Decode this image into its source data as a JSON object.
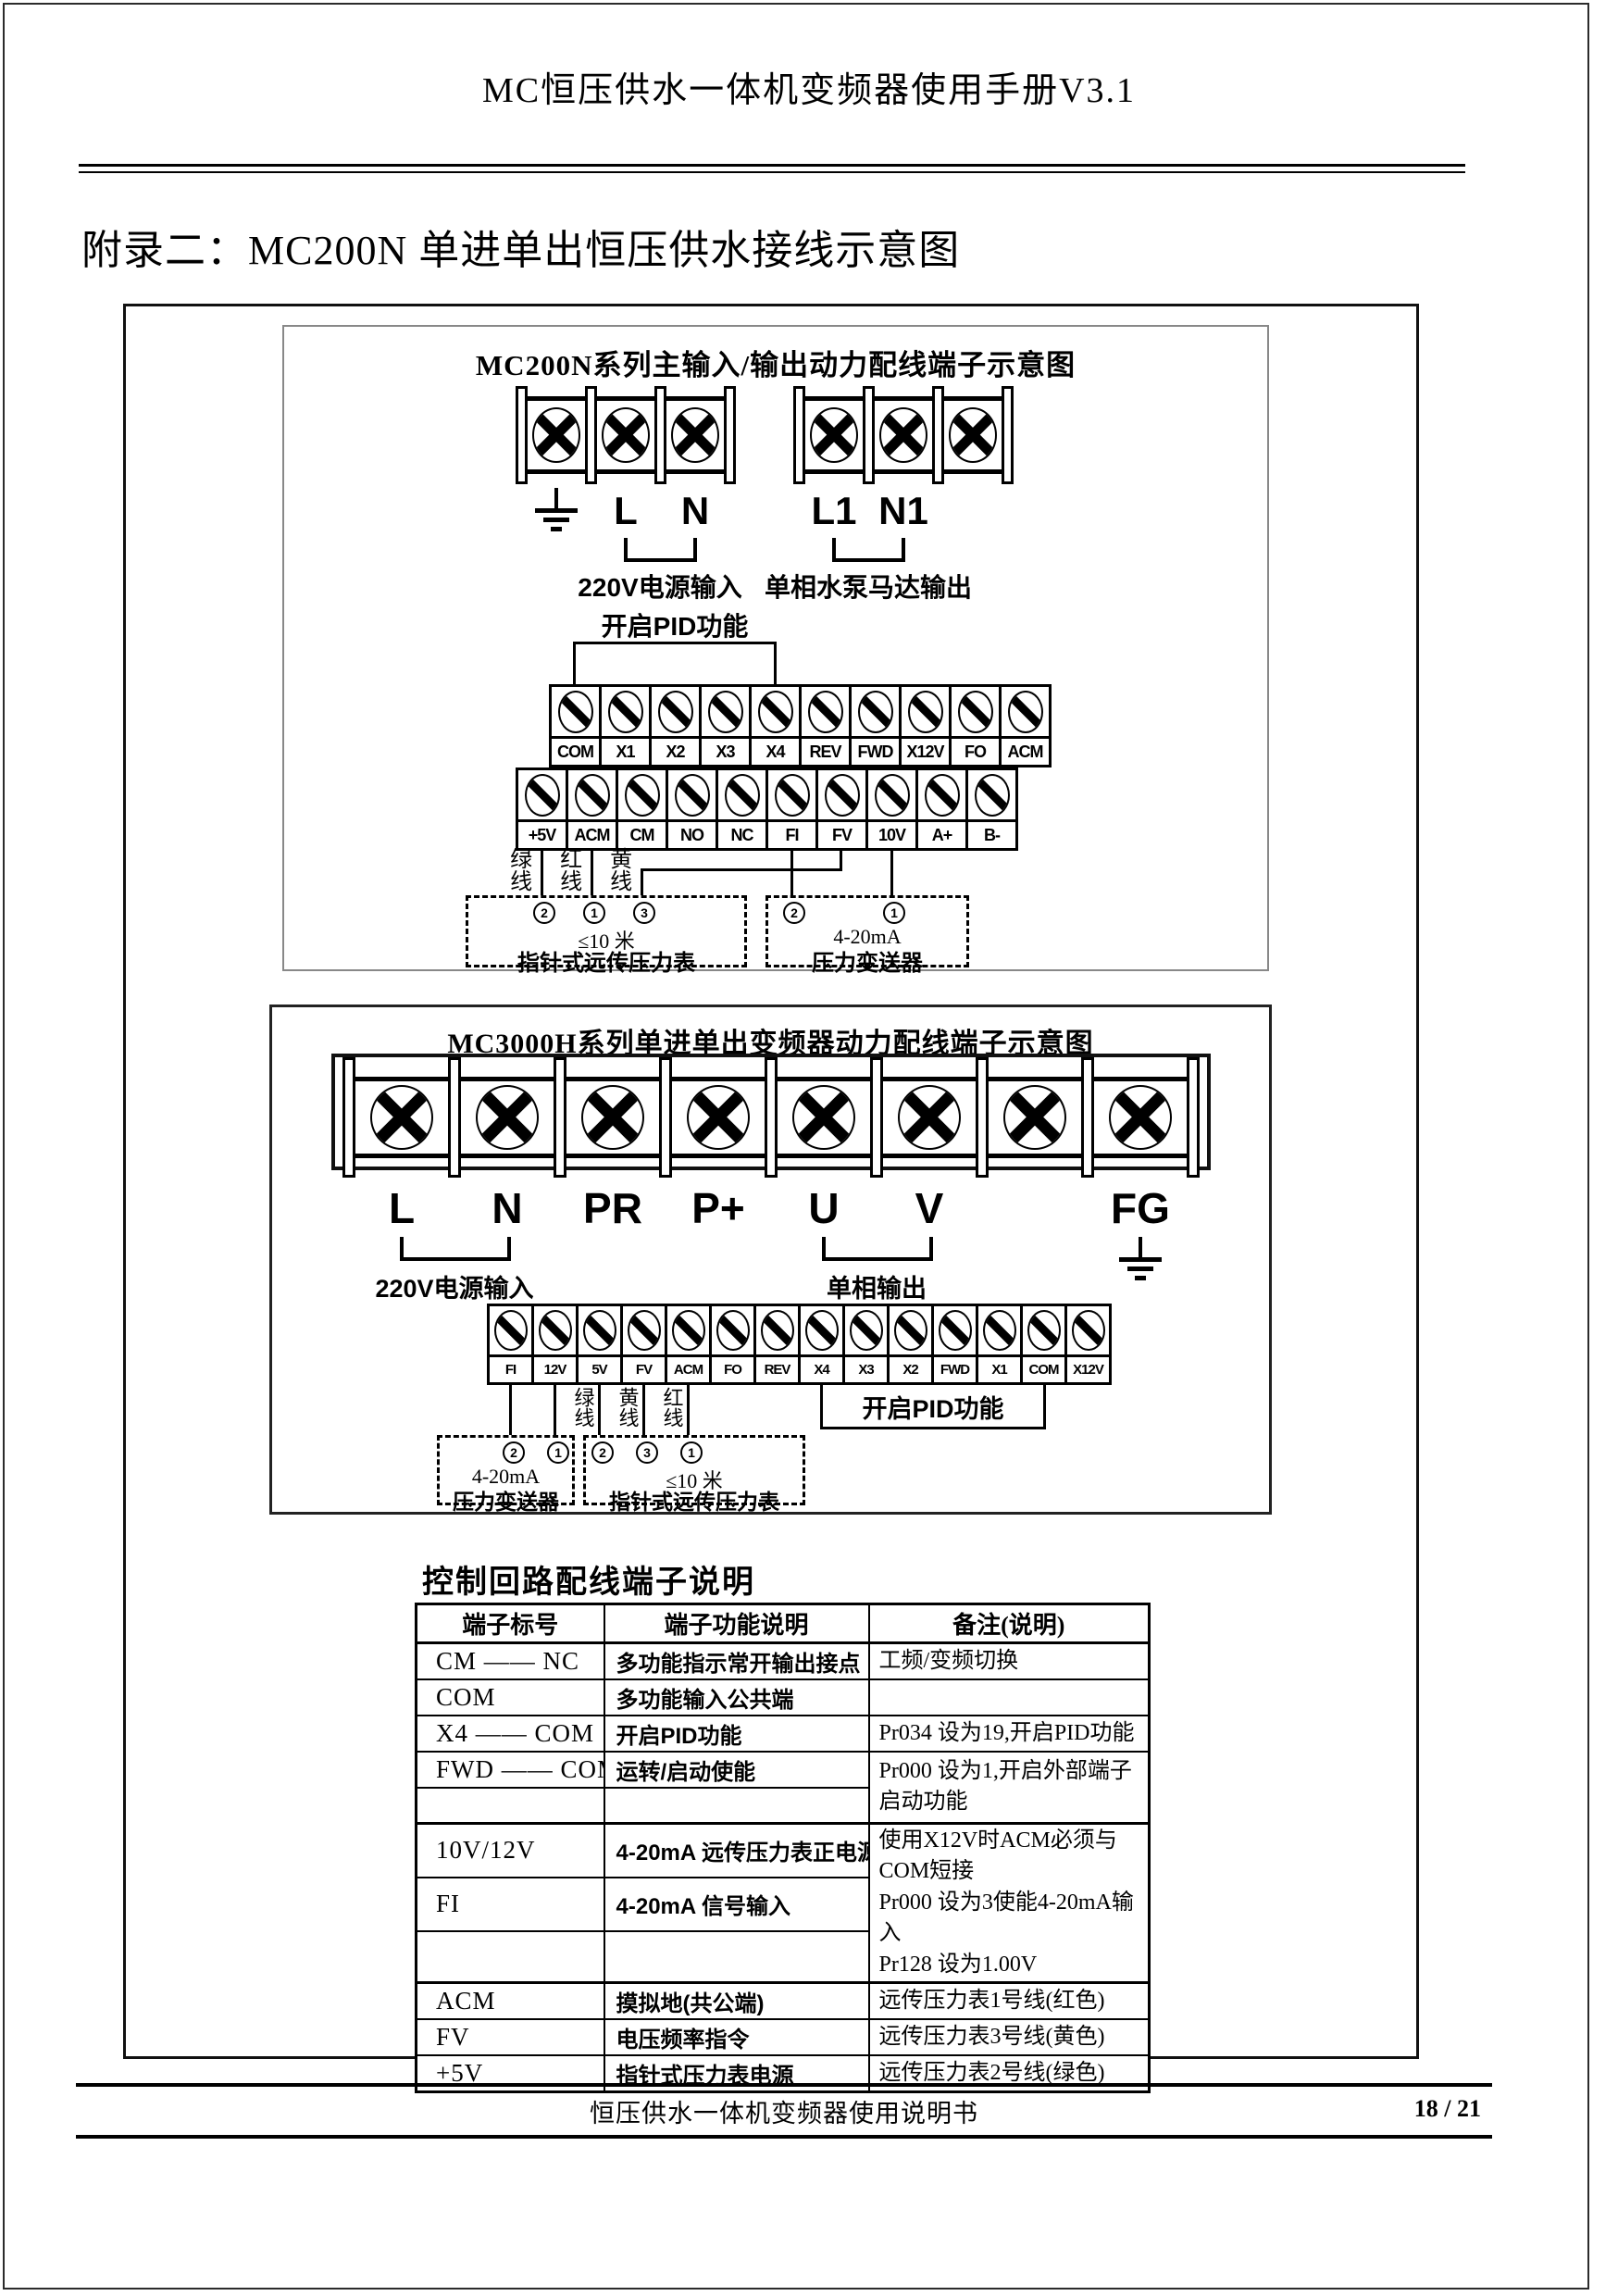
{
  "page": {
    "header_title": "MC恒压供水一体机变频器使用手册V3.1",
    "section_title": "附录二：MC200N 单进单出恒压供水接线示意图",
    "footer_text": "恒压供水一体机变频器使用说明书",
    "page_number": "18 / 21"
  },
  "icons": {
    "screw_cross": "screw-x-icon",
    "screw_slot": "screw-slash-icon",
    "ground": "ground-icon"
  },
  "diagram1": {
    "title": "MC200N系列主输入/输出动力配线端子示意图",
    "power_left": {
      "t2": "L",
      "t3": "N",
      "caption": "220V电源输入"
    },
    "power_right": {
      "t1": "L1",
      "t2": "N1",
      "caption": "单相水泵马达输出"
    },
    "pid_label": "开启PID功能",
    "ctrl_row1": [
      "COM",
      "X1",
      "X2",
      "X3",
      "X4",
      "REV",
      "FWD",
      "X12V",
      "FO",
      "ACM"
    ],
    "ctrl_row2": [
      "+5V",
      "ACM",
      "CM",
      "NO",
      "NC",
      "FI",
      "FV",
      "10V",
      "A+",
      "B-"
    ],
    "wire_green": "绿线",
    "wire_red": "红线",
    "wire_yellow": "黄线",
    "gauge_box": {
      "n1": "2",
      "n2": "1",
      "n3": "3",
      "line1": "≤10 米",
      "name": "指针式远传压力表"
    },
    "transmitter_box": {
      "n1": "2",
      "n2": "1",
      "line1": "4-20mA",
      "name": "压力变送器"
    }
  },
  "diagram2": {
    "title": "MC3000H系列单进单出变频器动力配线端子示意图",
    "power_labels": [
      "L",
      "N",
      "PR",
      "P+",
      "U",
      "V",
      "",
      "FG"
    ],
    "caption_left": "220V电源输入",
    "caption_right": "单相输出",
    "ctrl_row": [
      "FI",
      "12V",
      "5V",
      "FV",
      "ACM",
      "FO",
      "REV",
      "X4",
      "X3",
      "X2",
      "FWD",
      "X1",
      "COM",
      "X12V"
    ],
    "wire_green": "绿线",
    "wire_yellow": "黄线",
    "wire_red": "红线",
    "transmitter_box": {
      "n1": "2",
      "n2": "1",
      "line1": "4-20mA",
      "name": "压力变送器"
    },
    "gauge_box": {
      "n1": "2",
      "n2": "3",
      "n3": "1",
      "line1": "≤10 米",
      "name": "指针式远传压力表"
    },
    "pid_label": "开启PID功能"
  },
  "table": {
    "title": "控制回路配线端子说明",
    "headers": [
      "端子标号",
      "端子功能说明",
      "备注(说明)"
    ],
    "r1": {
      "term": "CM —— NC",
      "func": "多功能指示常开输出接点",
      "remark": "工频/变频切换"
    },
    "r2": {
      "term": "COM",
      "func": "多功能输入公共端"
    },
    "r3": {
      "term": "X4 —— COM",
      "func": "开启PID功能",
      "remark": "Pr034 设为19,开启PID功能"
    },
    "r4": {
      "term": "FWD —— COM",
      "func": "运转/启动使能",
      "remark1": "Pr000 设为1,开启外部端子",
      "remark2": "启动功能"
    },
    "r6": {
      "term": "10V/12V",
      "func": "4-20mA 远传压力表正电源",
      "remark1": "使用X12V时ACM必须与COM短接",
      "remark2": "Pr000 设为3使能4-20mA输入",
      "remark3": "Pr128 设为1.00V"
    },
    "r7": {
      "term": "FI",
      "func": "4-20mA 信号输入"
    },
    "r9": {
      "term": "ACM",
      "func": "摸拟地(共公端)",
      "remark": "远传压力表1号线(红色)"
    },
    "r10": {
      "term": "FV",
      "func": "电压频率指令",
      "remark": "远传压力表3号线(黄色)"
    },
    "r11": {
      "term": "+5V",
      "func": "指针式压力表电源",
      "remark": "远传压力表2号线(绿色)"
    }
  }
}
